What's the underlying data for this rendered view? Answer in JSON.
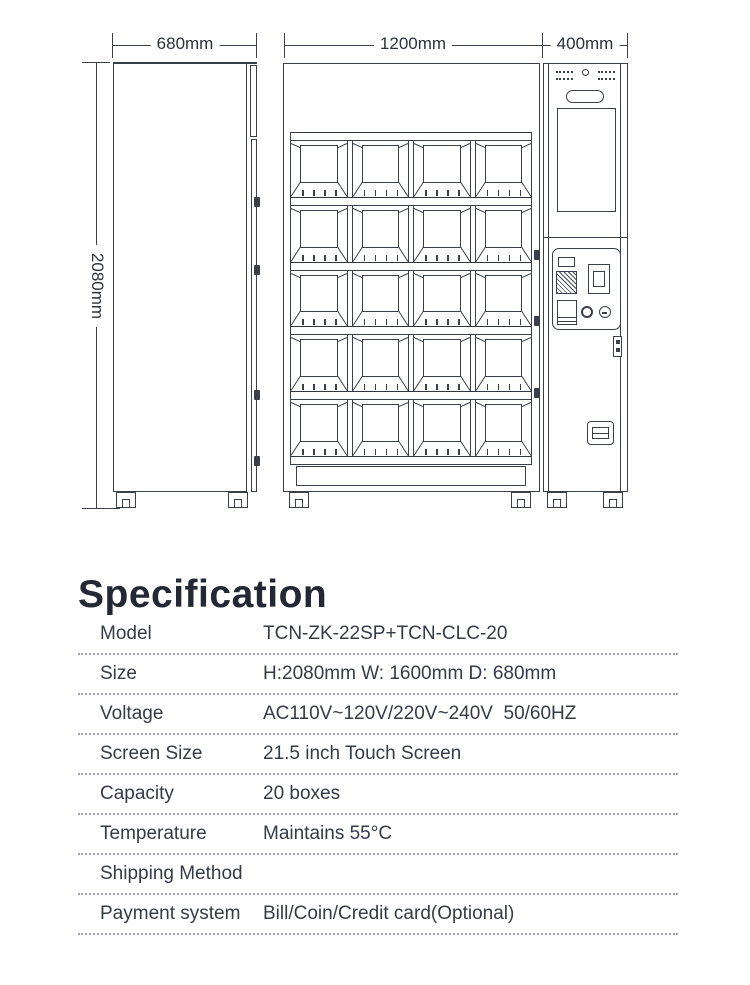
{
  "diagram": {
    "dim_depth_label": "680mm",
    "dim_width_label": "1200mm",
    "dim_side_label": "400mm",
    "dim_height_label": "2080mm",
    "grid": {
      "rows": 5,
      "cols": 4
    },
    "line_color": "#3a3f4a"
  },
  "spec": {
    "heading": "Specification",
    "rows": [
      {
        "label": "Model",
        "value": "TCN-ZK-22SP+TCN-CLC-20"
      },
      {
        "label": "Size",
        "value": "H:2080mm W: 1600mm D: 680mm"
      },
      {
        "label": "Voltage",
        "value": "AC110V~120V/220V~240V  50/60HZ"
      },
      {
        "label": "Screen Size",
        "value": "21.5 inch Touch Screen"
      },
      {
        "label": "Capacity",
        "value": "20 boxes"
      },
      {
        "label": "Temperature",
        "value": "Maintains 55°C"
      },
      {
        "label": "Shipping Method",
        "value": ""
      },
      {
        "label": "Payment system",
        "value": "Bill/Coin/Credit card(Optional)"
      }
    ]
  }
}
